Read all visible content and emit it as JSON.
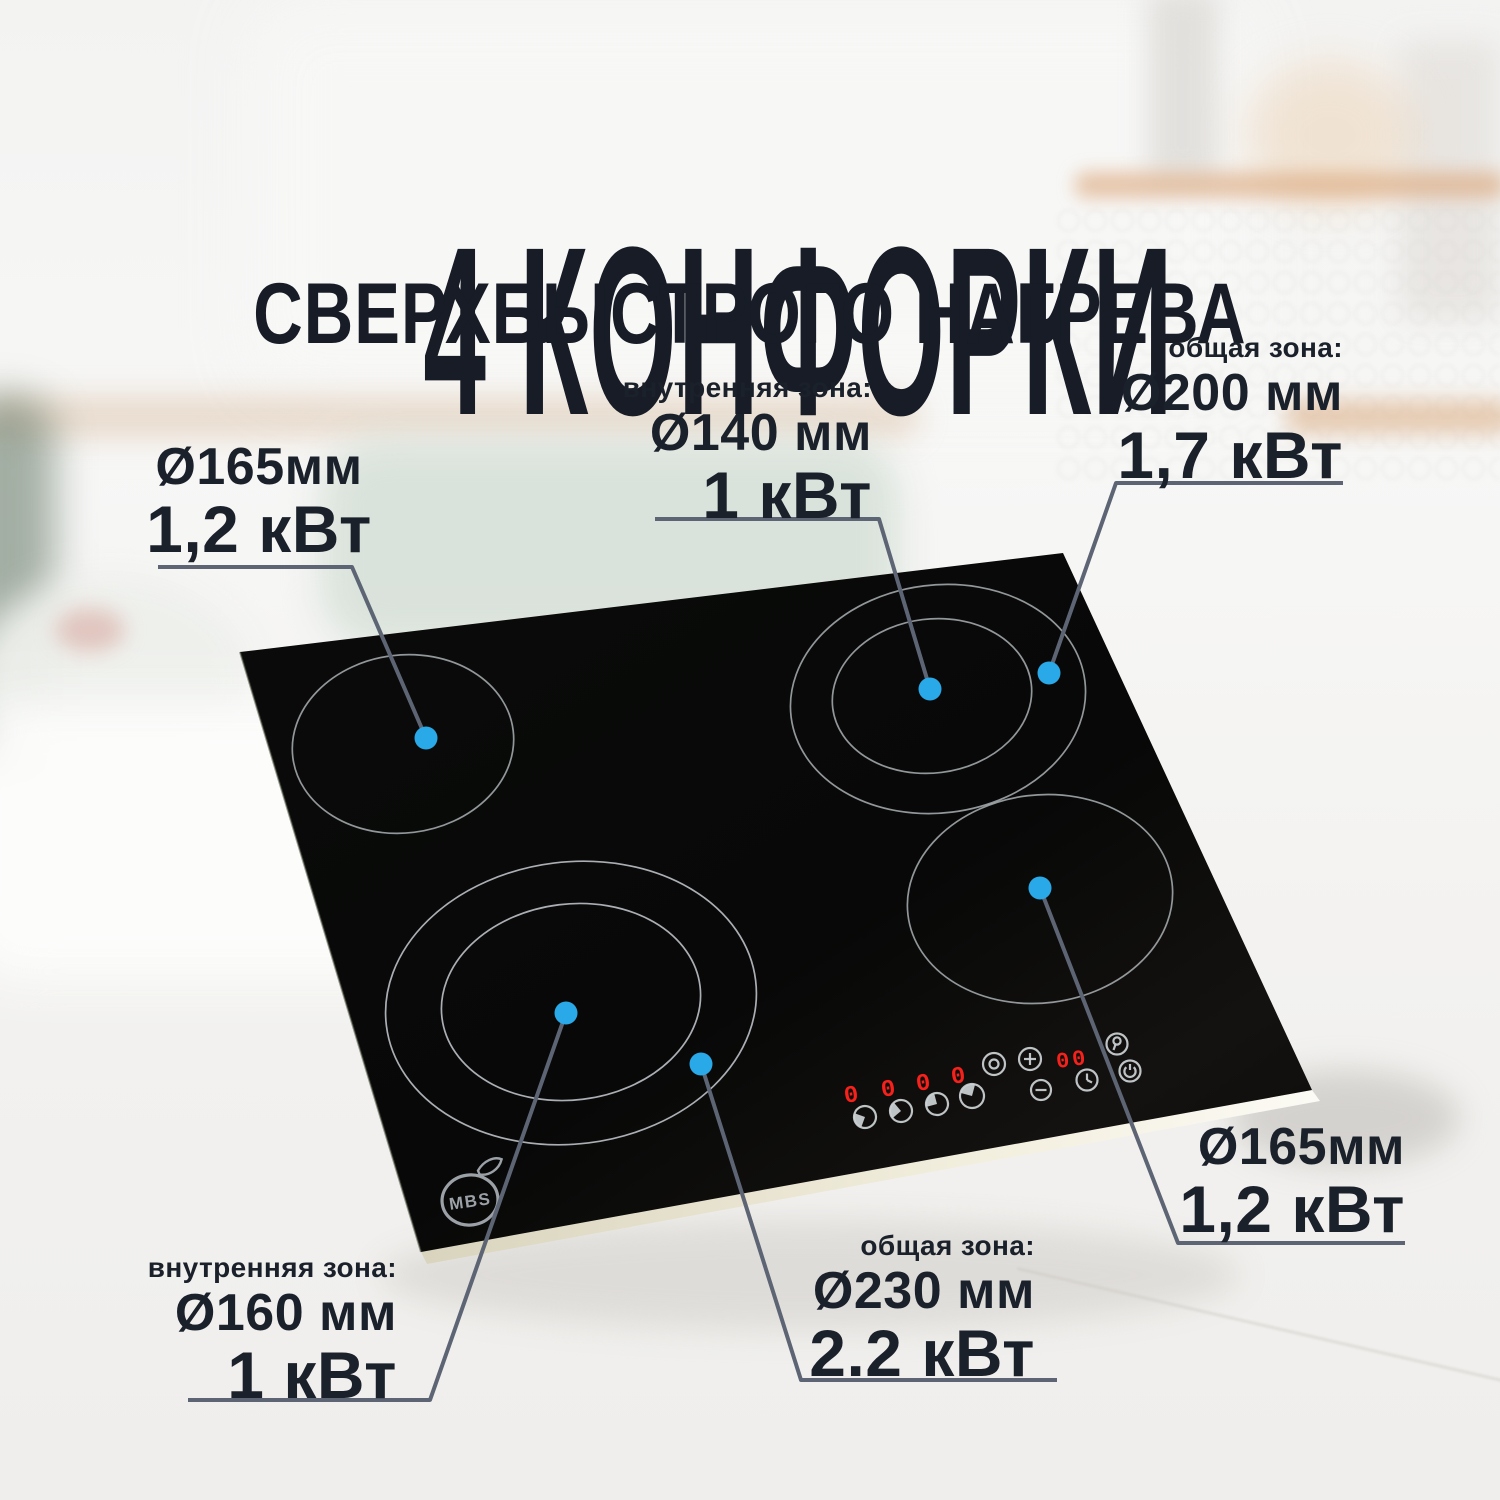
{
  "title": {
    "line1": "4 КОНФОРКИ",
    "line2": "СВЕРХБЫСТРОГО НАГРЕВА"
  },
  "callouts": {
    "top_left": {
      "diameter": "Ø165мм",
      "power": "1,2 кВт"
    },
    "top_middle": {
      "zone": "внутренняя зона:",
      "diameter": "Ø140 мм",
      "power": "1 кВт"
    },
    "top_right": {
      "zone": "общая зона:",
      "diameter": "Ø200 мм",
      "power": "1,7 кВт"
    },
    "bottom_left": {
      "zone": "внутренняя зона:",
      "diameter": "Ø160 мм",
      "power": "1 кВт"
    },
    "bottom_middle": {
      "zone": "общая зона:",
      "diameter": "Ø230 мм",
      "power": "2.2 кВт"
    },
    "bottom_right": {
      "diameter": "Ø165мм",
      "power": "1,2 кВт"
    }
  },
  "cooktop": {
    "brand_logo": "MBS",
    "burner_displays": [
      "0",
      "0",
      "0",
      "0"
    ],
    "timer_display": "00",
    "touch_icons": [
      "burner-dial",
      "burner-dial",
      "burner-dial",
      "burner-dial",
      "dual-zone",
      "plus",
      "minus",
      "timer-clock",
      "key-lock",
      "power"
    ]
  },
  "colors": {
    "accent_dot": "#2aa9e9",
    "callout_line": "#5d6574",
    "title_text": "#171c26",
    "label_text": "#1b212b",
    "led_red": "#f5211a",
    "glass_black": "#0a0a09"
  }
}
